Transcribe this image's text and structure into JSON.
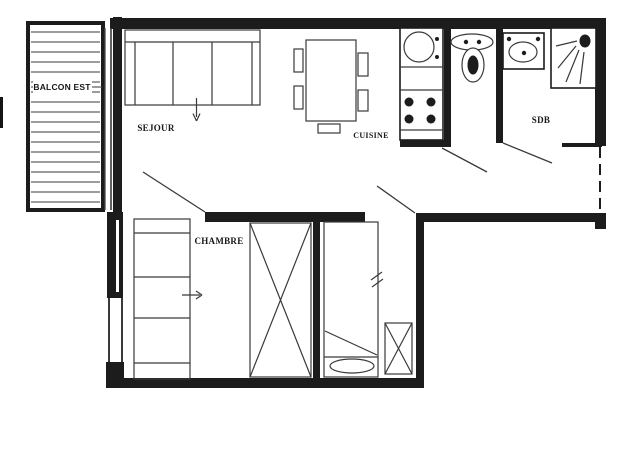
{
  "plan": {
    "type": "apartment-floor-plan",
    "labels": {
      "balcony": "BALCON EST",
      "living_room": "SEJOUR",
      "kitchen": "CUISINE",
      "bathroom": "SDB",
      "bedroom": "CHAMBRE"
    },
    "colors": {
      "wall": "#1c1c1c",
      "line": "#3a3a3a",
      "background": "#ffffff"
    }
  }
}
